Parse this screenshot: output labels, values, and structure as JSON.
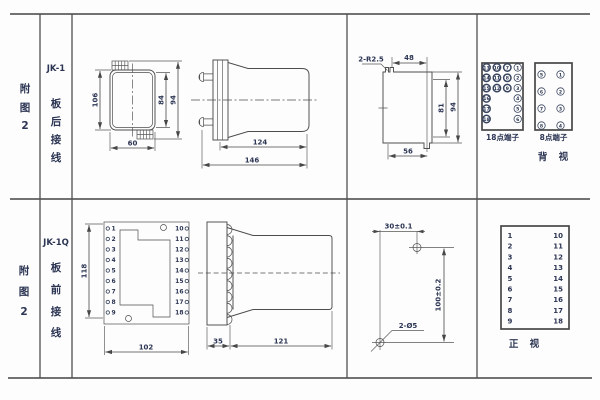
{
  "rows": {
    "r1": {
      "fig": [
        "附",
        "图",
        "2"
      ],
      "model": "JK-1",
      "wiring": [
        "板",
        "后",
        "接",
        "线"
      ],
      "front_view": {
        "height": "106",
        "width": "60",
        "inner_height": "84",
        "outer_height": "94"
      },
      "side_view": {
        "body_length": "124",
        "total_length": "146"
      },
      "panel_cutout": {
        "corner_radius": "2-R2.5",
        "top_width": "48",
        "inner_height": "81",
        "outer_height": "94",
        "bottom_width": "56"
      },
      "terminal18": {
        "title": "18点端子",
        "columns": [
          [
            "13",
            "14",
            "15",
            "16",
            "17",
            "18"
          ],
          [
            "10",
            "11",
            "12"
          ],
          [
            "7",
            "8",
            "9"
          ],
          [
            "1",
            "2",
            "3",
            "4",
            "5",
            "6"
          ]
        ]
      },
      "terminal8": {
        "title": "8点端子",
        "columns": [
          [
            "5",
            "6",
            "7",
            "8"
          ],
          [
            "1",
            "2",
            "3",
            "4"
          ]
        ]
      },
      "view_label": "背 视"
    },
    "r2": {
      "fig": [
        "附",
        "图",
        "2"
      ],
      "model": "JK-1Q",
      "wiring": [
        "板",
        "前",
        "接",
        "线"
      ],
      "board_view": {
        "height": "118",
        "width": "102",
        "left_terminals": [
          "1",
          "2",
          "3",
          "4",
          "5",
          "6",
          "7",
          "8",
          "9"
        ],
        "right_terminals": [
          "10",
          "11",
          "12",
          "13",
          "14",
          "15",
          "16",
          "17",
          "18"
        ]
      },
      "side_view": {
        "plate_depth": "35",
        "body_length": "121"
      },
      "drill_view": {
        "hole_spacing_h": "30±0.1",
        "hole_spacing_v": "100±0.2",
        "hole_label": "2-Ø5"
      },
      "front_table": {
        "left": [
          "1",
          "2",
          "3",
          "4",
          "5",
          "6",
          "7",
          "8",
          "9"
        ],
        "right": [
          "10",
          "11",
          "12",
          "13",
          "14",
          "15",
          "16",
          "17",
          "18"
        ],
        "view_label": "正 视"
      }
    }
  }
}
